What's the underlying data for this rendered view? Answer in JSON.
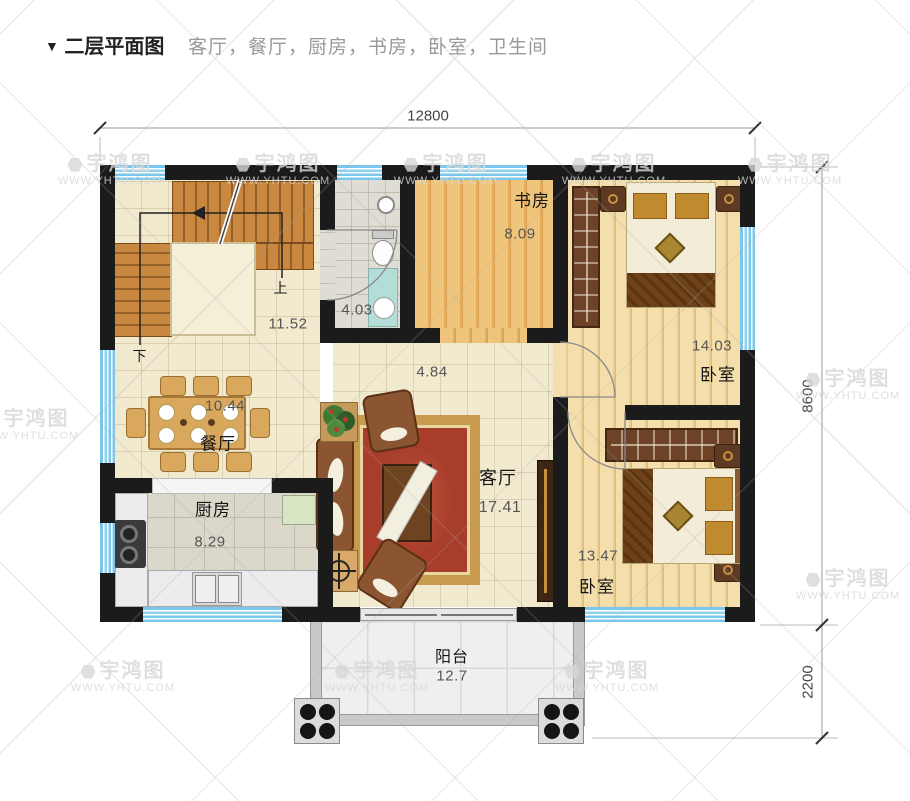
{
  "header": {
    "marker": "▼",
    "title": "二层平面图",
    "subtitle": "客厅，餐厅，厨房，书房，卧室，卫生间"
  },
  "dimensions": {
    "width": "12800",
    "height_main": "8600",
    "height_balcony": "2200"
  },
  "rooms": {
    "stairs": {
      "area": "11.52",
      "label_up": "上",
      "label_down": "下"
    },
    "bathroom": {
      "area": "4.03"
    },
    "study": {
      "name": "书房",
      "area": "8.09"
    },
    "bedroom1": {
      "name": "卧室",
      "area": "14.03"
    },
    "bedroom2": {
      "name": "卧室",
      "area": "13.47"
    },
    "living": {
      "name": "客厅",
      "area": "17.41"
    },
    "dining": {
      "name": "餐厅",
      "area": "10.44"
    },
    "kitchen": {
      "name": "厨房",
      "area": "8.29"
    },
    "hallway": {
      "area": "4.84"
    },
    "balcony": {
      "name": "阳台",
      "area": "12.7"
    }
  },
  "watermark": {
    "logo": "宇鸿图",
    "url": "WWW.YHTU.COM"
  },
  "colors": {
    "wall": "#1b1b1b",
    "window_blue": "#7ec9ea",
    "stair_wood": "#c9873f",
    "study_wood": "#e8b467",
    "bedroom_wood": "#f0d49c",
    "rug_red": "#a93d2b",
    "rug_border": "#c79a4f"
  }
}
